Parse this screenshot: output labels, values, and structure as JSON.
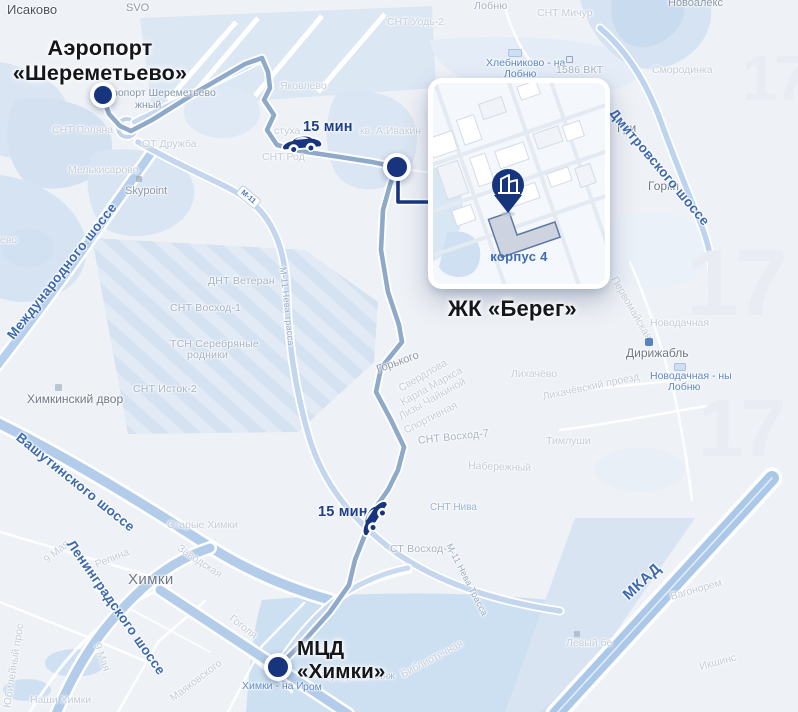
{
  "big_labels": {
    "airport_line1": "Аэропорт",
    "airport_line2": "«Шереметьево»",
    "bereg": "ЖК «Берег»",
    "mcd_line1": "МЦД",
    "mcd_line2": "«Химки»"
  },
  "route": {
    "time_airport": "15 мин",
    "time_khimki": "15 мин"
  },
  "inset": {
    "building_label": "корпус 4"
  },
  "road_labels": {
    "mezhdunarodnoe": "Международного шоссе",
    "vashutinskoe": "Вашутинского шоссе",
    "leningradskoe": "Ленинградского шоссе",
    "dmitrovskoe": "Дмитровского шоссе",
    "mkad": "МКАД",
    "m11_badge": "М-11",
    "m11_vertical": "М-11 Нева трасса",
    "m11_south": "М-11 Нева Трасса"
  },
  "map_labels": {
    "isakovo": "Исаково",
    "svo": "SVO",
    "lobnya_top": "Лобню",
    "snt_michur": "СНТ Мичур",
    "novoaleks": "Новоалекс",
    "snt_uod": "СНТ Уодь-2",
    "khlebnikovo_line1": "Хлебниково - на",
    "khlebnikovo_line2": "Лобню",
    "vkt": "1586 ВКТ",
    "smorodinka": "Смородинка",
    "gorki": "Горки",
    "gri": "Гри",
    "airport_poi_line1": "ропорт Шереметьево",
    "airport_poi_line2": "жный",
    "snt_polyana": "СНТ Поляна",
    "ot_druzhba": "ОТ Дружба",
    "melkisarovo": "Мелькисарово",
    "skypoint": "Skypoint",
    "evo": "ево",
    "yakovlevo": "Яковлево",
    "stukha": "стуха",
    "snt_rod": "СНТ Род",
    "kv_ivakin": "кв. А.Ивакин",
    "dnt_veteran": "ДНТ Ветеран",
    "snt_voskhod1": "СНТ Восход-1",
    "tsn_line1": "ТСН Серебряные",
    "tsn_line2": "родники",
    "snt_istok2": "СНТ Исток-2",
    "khimkinsky_dvor": "Химкинский двор",
    "gorkogo": "Горького",
    "sverdlova": "Свердлова",
    "karla_marksa": "Карла Маркса",
    "lizy_chaykinoy": "Лизы Чайкиной",
    "sportivnaya": "Спортивная",
    "snt_voskhod7": "СНТ Восход-7",
    "naberezhny": "Набережный",
    "timlushi": "Тимлуши",
    "snt_niva": "СНТ Нива",
    "st_voskhod1": "СТ Восход-1",
    "likhachevo": "Лихачёво",
    "likhachevsky": "Лихачёвский проезд",
    "dirizhabl": "Дирижабль",
    "novodachnaya_faint": "Новодачная",
    "novodachnaya_line1": "Новодачная - ны",
    "novodachnaya_line2": "Лобню",
    "pervomayskaya": "Первомайская",
    "starye_khimki": "Старые Химки",
    "zavodskaya": "Заводская",
    "repina": "Репина",
    "maya9_a": "9 Мая",
    "maya9_b": "9 Мая",
    "khimki_city": "Химки",
    "gogolya": "Гоголя",
    "mayakovskogo": "Маяковского",
    "yubileyny": "Юбилейный прос",
    "nashi_khimki": "Наши Химки",
    "gorodskoy_plyazh": "Городской пляж",
    "khimki_station_line1": "Химки - на И",
    "khimki_station_line2": "ром",
    "bibliotechnaya": "Библиотечная",
    "levy_bereg": "Левый бе",
    "vagonorem": "Вагонорем",
    "ikshins": "Икшинс"
  },
  "watermark": "17",
  "colors": {
    "marker_navy": "#16357e",
    "route_line": "#8fa9c9",
    "road_fill": "#b6cfec",
    "road_label_blue": "#3c69ae",
    "water_fill": "#d3e1f1",
    "big_label_black": "#14161a"
  }
}
